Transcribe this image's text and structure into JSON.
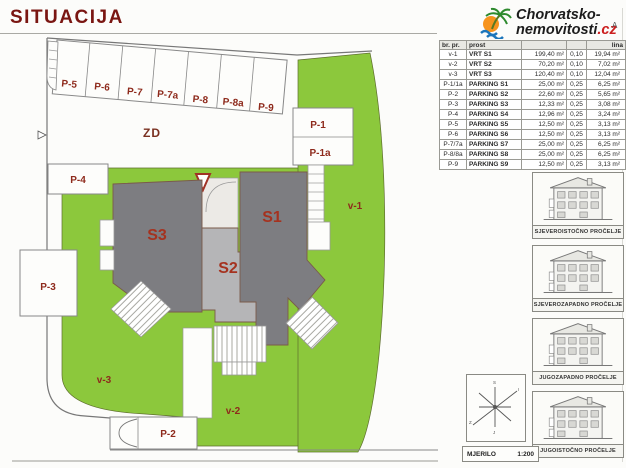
{
  "title": "SITUACIJA",
  "logo": {
    "line1": "Chorvatsko-",
    "line2_black": "nemovitosti",
    "line2_red": ".cz",
    "corner_letter": "A"
  },
  "table": {
    "headers": [
      "br. pr.",
      "prost",
      "",
      "",
      "lina"
    ],
    "rows": [
      [
        "v-1",
        "VRT S1",
        "199,40 m²",
        "0,10",
        "19,94 m²"
      ],
      [
        "v-2",
        "VRT S2",
        "70,20 m²",
        "0,10",
        "7,02 m²"
      ],
      [
        "v-3",
        "VRT S3",
        "120,40 m²",
        "0,10",
        "12,04 m²"
      ],
      [
        "P-1/1a",
        "PARKING S1",
        "25,00 m²",
        "0,25",
        "6,25 m²"
      ],
      [
        "P-2",
        "PARKING S2",
        "22,60 m²",
        "0,25",
        "5,65 m²"
      ],
      [
        "P-3",
        "PARKING S3",
        "12,33 m²",
        "0,25",
        "3,08 m²"
      ],
      [
        "P-4",
        "PARKING S4",
        "12,96 m²",
        "0,25",
        "3,24 m²"
      ],
      [
        "P-5",
        "PARKING S5",
        "12,50 m²",
        "0,25",
        "3,13 m²"
      ],
      [
        "P-6",
        "PARKING S6",
        "12,50 m²",
        "0,25",
        "3,13 m²"
      ],
      [
        "P-7/7a",
        "PARKING S7",
        "25,00 m²",
        "0,25",
        "6,25 m²"
      ],
      [
        "P-8/8a",
        "PARKING S8",
        "25,00 m²",
        "0,25",
        "6,25 m²"
      ],
      [
        "P-9",
        "PARKING S9",
        "12,50 m²",
        "0,25",
        "3,13 m²"
      ]
    ]
  },
  "plan": {
    "labels": {
      "zd": "ZD",
      "v1": "v-1",
      "v2": "v-2",
      "v3": "v-3",
      "s1": "S1",
      "s2": "S2",
      "s3": "S3",
      "p1": "P-1",
      "p1a": "P-1a",
      "p2": "P-2",
      "p3": "P-3",
      "p4": "P-4",
      "p5": "P-5",
      "p6": "P-6",
      "p7": "P-7",
      "p7a": "P-7a",
      "p8": "P-8",
      "p8a": "P-8a",
      "p9": "P-9"
    }
  },
  "facades": [
    {
      "caption": "SJEVEROISTOČNO PROČELJE"
    },
    {
      "caption": "SJEVEROZAPADNO PROČELJE"
    },
    {
      "caption": "JUGOZAPADNO PROČELJE"
    },
    {
      "caption": "JUGOISTOČNO PROČELJE"
    }
  ],
  "scale_bar": {
    "label": "MJERILO",
    "value": "1:200"
  },
  "colors": {
    "lawn_green": "#8cc83c",
    "building_dark": "#7d7d81",
    "building_light": "#b5b5b7",
    "label_red": "#9a2d1f",
    "title_red": "#7a1612"
  }
}
